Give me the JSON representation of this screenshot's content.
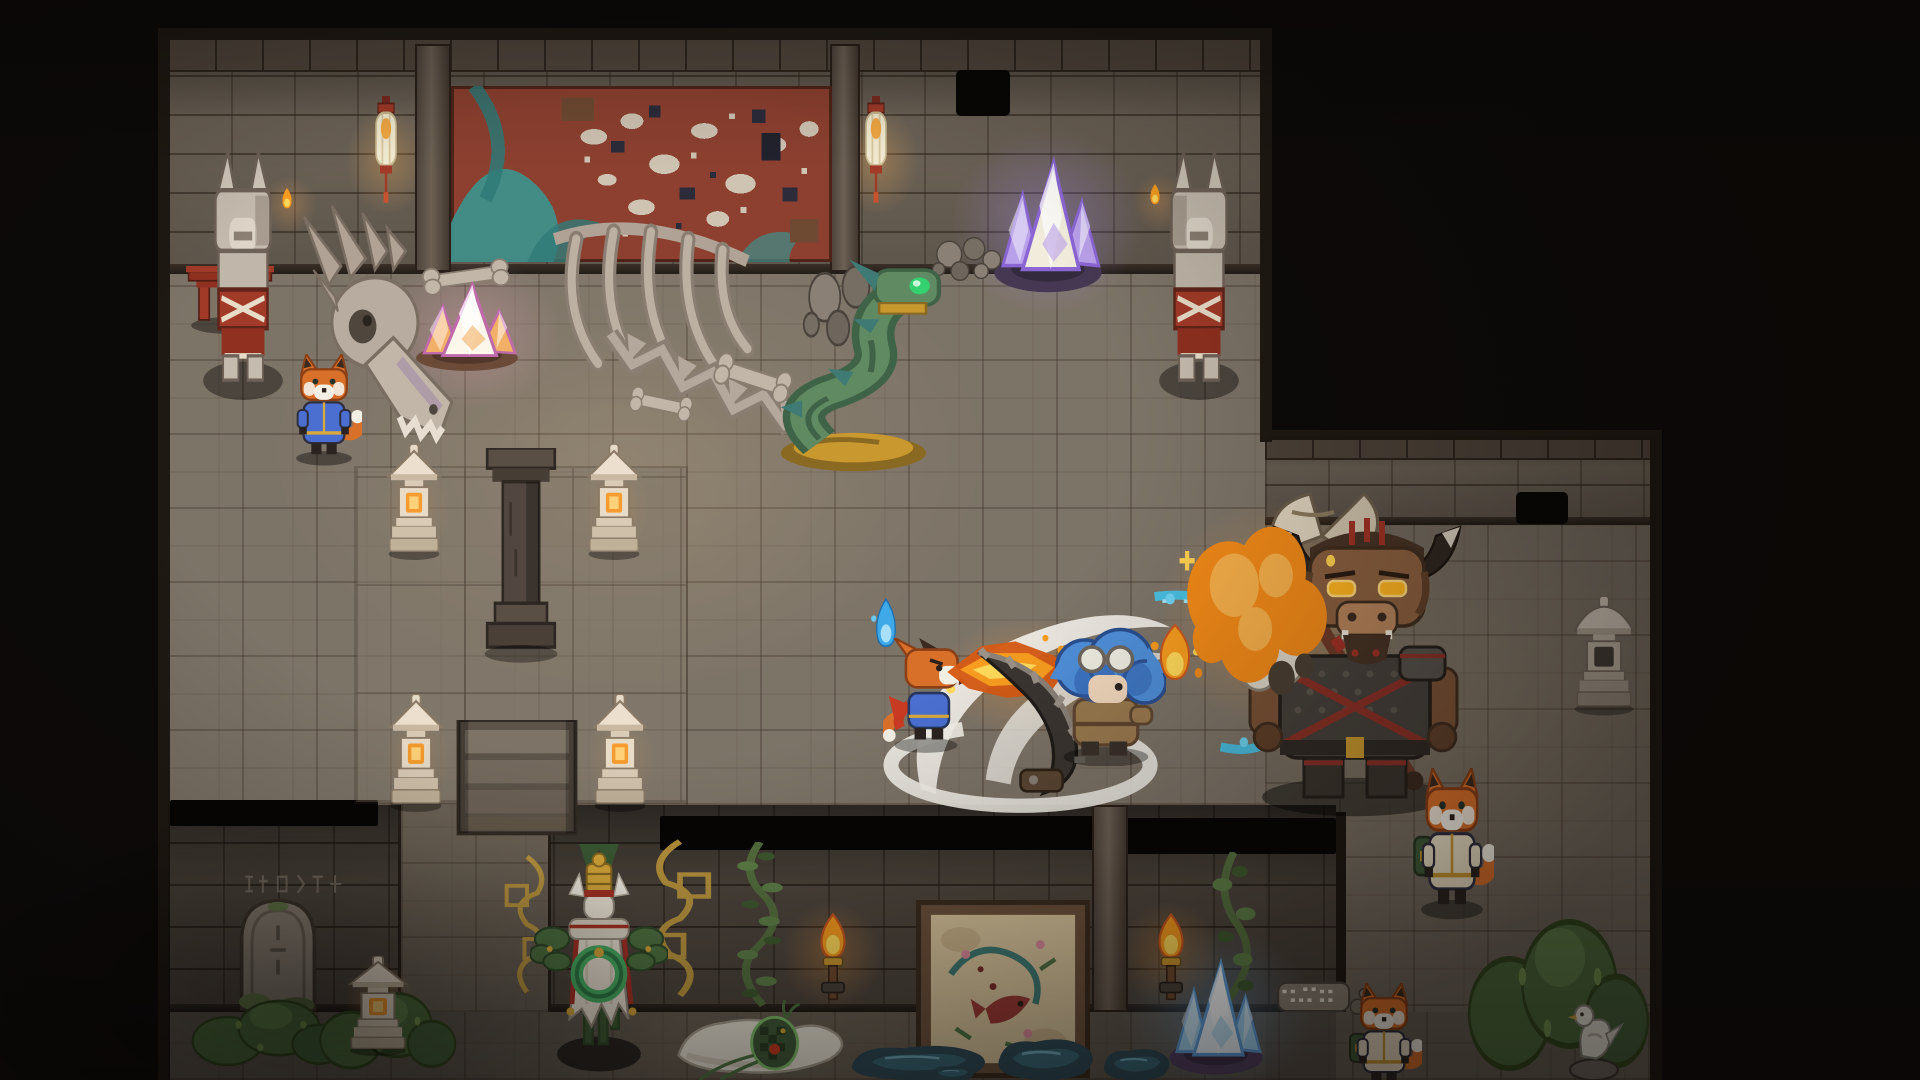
{
  "scene": {
    "palette": {
      "floor": "#7d7468",
      "floor_dark": "#6e665b",
      "wall": "#6e6458",
      "wall_dark": "#5b5248",
      "outline": "#241c15",
      "stone": "#c5bbae",
      "stone_dark": "#8a7d6f",
      "bone": "#b8aca0",
      "red": "#a23a28",
      "red_deep": "#6e241a",
      "gold": "#c9982f",
      "jade": "#49b065",
      "leaf": "#4f7342",
      "moss": "#4d6b3d",
      "fire": "#f79c1f",
      "fire_core": "#ffd95a",
      "fire_deep": "#d45a14",
      "fox": "#d9702a",
      "fox_dark": "#8a3f16",
      "fox_muzzle": "#f4efe4",
      "robe_blue": "#4a6fd0",
      "hero_hair": "#4f8fd9",
      "hero_hair_dark": "#2f5fae",
      "hero_coat": "#9a7a4f",
      "mino_fur": "#8a5f3f",
      "mino_mane": "#463224",
      "mino_armor": "#45403a",
      "eye_glow": "#ffb41f",
      "crystal_pink": "#f2b066",
      "crystal_purple": "#b9a0ea",
      "crystal_blue": "#9fd4f2",
      "mural_red": "#8d4030",
      "mural_teal": "#3f8f8a",
      "mural_cream": "#cfc3b2",
      "mural_navy": "#2b2b3a",
      "water": "#45c8f0",
      "puddle": "#2e4a57",
      "puddle_light": "#3a6a7a",
      "slash": "#f2efe8",
      "parchment": "#d8c49c",
      "frame_brown": "#6b513c"
    },
    "rooms": [
      {
        "cls": "floor",
        "name": "top-room-floor",
        "x": 168,
        "y": 272,
        "w": 1097,
        "h": 533
      },
      {
        "cls": "floor floor-right",
        "name": "right-room-floor",
        "x": 1265,
        "y": 525,
        "w": 391,
        "h": 555
      },
      {
        "cls": "floor floor-bottom",
        "name": "bottom-room-floor",
        "x": 168,
        "y": 1012,
        "w": 1488,
        "h": 68
      },
      {
        "cls": "wall-face",
        "name": "top-room-wall",
        "x": 168,
        "y": 38,
        "w": 1097,
        "h": 234
      },
      {
        "cls": "cap",
        "name": "top-wall-cap",
        "x": 168,
        "y": 38,
        "w": 1097,
        "h": 32
      },
      {
        "cls": "wall-lip",
        "name": "top-wall-lip",
        "x": 168,
        "y": 264,
        "w": 1097,
        "h": 10
      },
      {
        "cls": "wall-face",
        "name": "right-room-wall",
        "x": 1265,
        "y": 436,
        "w": 391,
        "h": 89
      },
      {
        "cls": "cap",
        "name": "right-wall-cap",
        "x": 1265,
        "y": 436,
        "w": 391,
        "h": 22
      },
      {
        "cls": "wall-lip",
        "name": "right-wall-lip",
        "x": 1265,
        "y": 517,
        "w": 391,
        "h": 8
      },
      {
        "cls": "wall-band",
        "name": "bottom-room-wall",
        "x": 168,
        "y": 805,
        "w": 1168,
        "h": 207
      },
      {
        "cls": "wall-lip",
        "name": "bottom-wall-lip",
        "x": 168,
        "y": 1004,
        "w": 1168,
        "h": 8
      },
      {
        "cls": "floor floor-passage",
        "name": "passage-floor",
        "x": 398,
        "y": 805,
        "w": 147,
        "h": 207
      },
      {
        "cls": "edge",
        "name": "map-edge-left",
        "x": 158,
        "y": 30,
        "w": 12,
        "h": 1050
      },
      {
        "cls": "edge",
        "name": "map-edge-top",
        "x": 158,
        "y": 28,
        "w": 1114,
        "h": 12
      },
      {
        "cls": "edge",
        "name": "map-edge-topright-v",
        "x": 1260,
        "y": 28,
        "w": 12,
        "h": 414
      },
      {
        "cls": "edge",
        "name": "map-edge-rightroom-top",
        "x": 1260,
        "y": 430,
        "w": 402,
        "h": 10
      },
      {
        "cls": "edge",
        "name": "map-edge-right",
        "x": 1650,
        "y": 430,
        "w": 12,
        "h": 650
      },
      {
        "cls": "edge",
        "name": "bottom-wall-right-edge",
        "x": 1336,
        "y": 812,
        "w": 10,
        "h": 200
      },
      {
        "cls": "tint",
        "name": "bottom-room-shading",
        "x": 168,
        "y": 805,
        "w": 1168,
        "h": 275
      },
      {
        "cls": "tint-light",
        "name": "right-room-shading",
        "x": 1265,
        "y": 436,
        "w": 391,
        "h": 644
      }
    ],
    "entities": [
      {
        "t": "glow",
        "n": "ambient-warm-light",
        "x": 240,
        "y": 250,
        "w": 760,
        "h": 520,
        "color": "rgba(240,200,140,0.08)"
      },
      {
        "t": "glow",
        "n": "pink-crystal-glow",
        "x": 345,
        "y": 225,
        "w": 250,
        "h": 215,
        "color": "rgba(255,170,200,0.30)"
      },
      {
        "t": "glow",
        "n": "purple-crystal-glow",
        "x": 915,
        "y": 95,
        "w": 265,
        "h": 255,
        "color": "rgba(170,140,255,0.33)"
      },
      {
        "t": "glow",
        "n": "lantern-glow",
        "x": 330,
        "y": 85,
        "w": 115,
        "h": 150,
        "color": "rgba(255,180,80,0.30)"
      },
      {
        "t": "glow",
        "n": "lantern-glow",
        "x": 820,
        "y": 85,
        "w": 115,
        "h": 150,
        "color": "rgba(255,180,80,0.30)"
      },
      {
        "t": "glow",
        "n": "stone-lantern-glow",
        "x": 368,
        "y": 445,
        "w": 95,
        "h": 130,
        "color": "rgba(255,170,70,0.28)"
      },
      {
        "t": "glow",
        "n": "stone-lantern-glow",
        "x": 568,
        "y": 445,
        "w": 95,
        "h": 130,
        "color": "rgba(255,170,70,0.28)"
      },
      {
        "t": "glow",
        "n": "stone-lantern-glow",
        "x": 370,
        "y": 692,
        "w": 95,
        "h": 132,
        "color": "rgba(255,170,70,0.28)"
      },
      {
        "t": "glow",
        "n": "stone-lantern-glow",
        "x": 574,
        "y": 692,
        "w": 95,
        "h": 132,
        "color": "rgba(255,170,70,0.28)"
      },
      {
        "t": "glow",
        "n": "stone-lantern-glow",
        "x": 330,
        "y": 940,
        "w": 100,
        "h": 130,
        "color": "rgba(255,170,70,0.28)"
      },
      {
        "t": "glow",
        "n": "fire-breath-glow",
        "x": 905,
        "y": 595,
        "w": 250,
        "h": 165,
        "color": "rgba(255,150,40,0.30)"
      },
      {
        "t": "glow",
        "n": "explosion-glow",
        "x": 1110,
        "y": 455,
        "w": 340,
        "h": 320,
        "color": "rgba(255,160,60,0.33)"
      },
      {
        "t": "glow",
        "n": "blue-crystal-glow",
        "x": 1085,
        "y": 895,
        "w": 265,
        "h": 235,
        "color": "rgba(110,190,255,0.30)"
      },
      {
        "t": "glow",
        "n": "torch-glow",
        "x": 762,
        "y": 880,
        "w": 140,
        "h": 150,
        "color": "rgba(255,160,60,0.30)"
      },
      {
        "t": "glow",
        "n": "torch-glow",
        "x": 1100,
        "y": 880,
        "w": 140,
        "h": 150,
        "color": "rgba(255,160,60,0.30)"
      },
      {
        "t": "glow",
        "n": "statue-ember-glow",
        "x": 252,
        "y": 165,
        "w": 75,
        "h": 80,
        "color": "rgba(255,170,80,0.25)"
      },
      {
        "t": "glow",
        "n": "statue-ember-glow",
        "x": 1122,
        "y": 162,
        "w": 75,
        "h": 80,
        "color": "rgba(255,170,80,0.25)"
      },
      {
        "t": "pillar",
        "n": "wall-pillar",
        "x": 415,
        "y": 44,
        "w": 36,
        "h": 228
      },
      {
        "t": "pillar",
        "n": "wall-pillar",
        "x": 830,
        "y": 44,
        "w": 30,
        "h": 228
      },
      {
        "t": "mural-top",
        "n": "wall-mural-tapestry",
        "x": 451,
        "y": 86,
        "w": 381,
        "h": 176
      },
      {
        "t": "hole",
        "n": "broken-wall-hole",
        "x": 956,
        "y": 70,
        "w": 54,
        "h": 46
      },
      {
        "t": "hole",
        "n": "broken-wall-hole",
        "x": 1516,
        "y": 492,
        "w": 52,
        "h": 32
      },
      {
        "t": "pit",
        "n": "wall-opening-slot",
        "x": 170,
        "y": 800,
        "w": 208,
        "h": 26
      },
      {
        "t": "pit",
        "n": "wall-opening-slot",
        "x": 660,
        "y": 816,
        "w": 434,
        "h": 34
      },
      {
        "t": "pit",
        "n": "wall-opening-slot",
        "x": 1126,
        "y": 818,
        "w": 210,
        "h": 36
      },
      {
        "t": "pillar",
        "n": "wall-pillar",
        "x": 1092,
        "y": 805,
        "w": 36,
        "h": 207
      },
      {
        "t": "carved-marks",
        "n": "wall-carvings",
        "x": 238,
        "y": 868,
        "w": 112,
        "h": 32
      },
      {
        "t": "vine",
        "n": "wall-vine",
        "x": 726,
        "y": 842,
        "w": 68,
        "h": 168
      },
      {
        "t": "vine",
        "n": "wall-vine",
        "x": 1202,
        "y": 852,
        "w": 64,
        "h": 228
      },
      {
        "t": "halo-arc",
        "n": "gold-filigree",
        "x": 494,
        "y": 852,
        "w": 66,
        "h": 145
      },
      {
        "t": "halo-arc",
        "n": "gold-filigree",
        "x": 634,
        "y": 836,
        "w": 92,
        "h": 165,
        "flip": true
      },
      {
        "t": "mural-bottom",
        "n": "wall-fresco",
        "x": 916,
        "y": 900,
        "w": 174,
        "h": 178
      },
      {
        "t": "torch",
        "n": "wall-torch",
        "x": 808,
        "y": 910,
        "w": 50,
        "h": 106
      },
      {
        "t": "torch",
        "n": "wall-torch",
        "x": 1146,
        "y": 910,
        "w": 50,
        "h": 106
      },
      {
        "t": "patch",
        "n": "altar-floor-tiles",
        "x": 356,
        "y": 468,
        "w": 330,
        "h": 334
      },
      {
        "t": "red-shrine",
        "n": "red-shrine-remnant",
        "x": 186,
        "y": 266,
        "w": 88,
        "h": 68
      },
      {
        "t": "paper-lantern",
        "n": "hanging-lantern",
        "x": 368,
        "y": 96,
        "w": 36,
        "h": 124
      },
      {
        "t": "paper-lantern",
        "n": "hanging-lantern",
        "x": 858,
        "y": 96,
        "w": 36,
        "h": 124
      },
      {
        "t": "fox-statue",
        "n": "fox-guardian-statue",
        "x": 194,
        "y": 146,
        "w": 98,
        "h": 254
      },
      {
        "t": "fox-statue",
        "n": "fox-guardian-statue",
        "x": 1150,
        "y": 146,
        "w": 98,
        "h": 254,
        "flip": true
      },
      {
        "t": "ember",
        "n": "statue-flame",
        "x": 278,
        "y": 186,
        "w": 18,
        "h": 26
      },
      {
        "t": "ember",
        "n": "statue-flame",
        "x": 1146,
        "y": 182,
        "w": 18,
        "h": 26
      },
      {
        "t": "crystal",
        "n": "purple-crystal-cluster",
        "x": 986,
        "y": 152,
        "w": 124,
        "h": 142,
        "css": {
          "--c1": "#f2ecdc",
          "--c2": "#b9a0ea",
          "--c3": "#8a66d4",
          "--mound": "#463853"
        }
      },
      {
        "t": "dragon-skull",
        "n": "dragon-skull-bones",
        "x": 298,
        "y": 202,
        "w": 160,
        "h": 264
      },
      {
        "t": "ribcage",
        "n": "skeleton-ribcage",
        "x": 542,
        "y": 210,
        "w": 218,
        "h": 168
      },
      {
        "t": "spine-tail",
        "n": "skeleton-spine",
        "x": 598,
        "y": 326,
        "w": 235,
        "h": 100,
        "rot": 10
      },
      {
        "t": "bone",
        "n": "scattered-bone",
        "x": 420,
        "y": 262,
        "w": 92,
        "h": 30,
        "rot": -8
      },
      {
        "t": "bone",
        "n": "scattered-bone",
        "x": 628,
        "y": 390,
        "w": 66,
        "h": 28,
        "rot": 12
      },
      {
        "t": "bone",
        "n": "scattered-bone",
        "x": 712,
        "y": 360,
        "w": 82,
        "h": 36,
        "rot": 18
      },
      {
        "t": "pebbles",
        "n": "rock-pile",
        "x": 798,
        "y": 256,
        "w": 98,
        "h": 96
      },
      {
        "t": "pebbles",
        "n": "rock-pile",
        "x": 928,
        "y": 232,
        "w": 78,
        "h": 52
      },
      {
        "t": "crystal",
        "n": "pink-crystal-cluster",
        "x": 408,
        "y": 278,
        "w": 118,
        "h": 94,
        "css": {
          "--c1": "#fdf6ea",
          "--c2": "#f2b066",
          "--c3": "#c06aac",
          "--mound": "#6b4a38"
        }
      },
      {
        "t": "serpent",
        "n": "jade-serpent-statue",
        "x": 768,
        "y": 256,
        "w": 188,
        "h": 218
      },
      {
        "t": "pedestal",
        "n": "stone-pedestal",
        "x": 482,
        "y": 448,
        "w": 78,
        "h": 216
      },
      {
        "t": "steps",
        "n": "altar-steps",
        "x": 452,
        "y": 720,
        "w": 130,
        "h": 120
      },
      {
        "t": "stone-lantern",
        "n": "stone-lantern-lit",
        "x": 384,
        "y": 444,
        "w": 60,
        "h": 116
      },
      {
        "t": "stone-lantern",
        "n": "stone-lantern-lit",
        "x": 584,
        "y": 444,
        "w": 60,
        "h": 116
      },
      {
        "t": "stone-lantern",
        "n": "stone-lantern-lit",
        "x": 386,
        "y": 694,
        "w": 60,
        "h": 118
      },
      {
        "t": "stone-lantern",
        "n": "stone-lantern-lit",
        "x": 590,
        "y": 694,
        "w": 60,
        "h": 118
      },
      {
        "t": "fox-npc",
        "n": "fox-npc-blue-robe",
        "x": 286,
        "y": 354,
        "w": 76,
        "h": 112,
        "variant": "plain",
        "inter": true,
        "css": {
          "--robe": "#4a6fd0",
          "--trim": "#d9a93a"
        }
      },
      {
        "t": "blue-flame",
        "n": "blue-flame-wisp",
        "x": 870,
        "y": 596,
        "w": 32,
        "h": 58
      },
      {
        "t": "slash-arcs",
        "n": "sword-slash-effect",
        "x": 876,
        "y": 594,
        "w": 324,
        "h": 226
      },
      {
        "t": "fox-fighter",
        "n": "fox-fighter-player",
        "x": 883,
        "y": 638,
        "w": 86,
        "h": 116,
        "inter": true
      },
      {
        "t": "fire-breath",
        "n": "fire-breath-attack",
        "x": 943,
        "y": 632,
        "w": 128,
        "h": 80
      },
      {
        "t": "chainsaw",
        "n": "chainsaw-blade-weapon",
        "x": 946,
        "y": 646,
        "w": 162,
        "h": 154
      },
      {
        "t": "hero",
        "n": "blue-haired-hero",
        "x": 1046,
        "y": 626,
        "w": 120,
        "h": 140,
        "inter": true
      },
      {
        "t": "water-trail",
        "n": "water-magic-trail",
        "x": 1143,
        "y": 583,
        "w": 194,
        "h": 182
      },
      {
        "t": "fire-puff",
        "n": "flame-burst",
        "x": 1146,
        "y": 622,
        "w": 58,
        "h": 66
      },
      {
        "t": "minotaur",
        "n": "minotaur-boss",
        "x": 1190,
        "y": 488,
        "w": 288,
        "h": 330,
        "inter": true
      },
      {
        "t": "explosion",
        "n": "explosion-cloud",
        "x": 1172,
        "y": 512,
        "w": 170,
        "h": 195
      },
      {
        "t": "stone-lantern-tall",
        "n": "stone-lantern-unlit",
        "x": 1570,
        "y": 596,
        "w": 68,
        "h": 120
      },
      {
        "t": "fox-npc",
        "n": "fox-npc-with-satchel",
        "x": 1410,
        "y": 768,
        "w": 84,
        "h": 152,
        "variant": "bag",
        "inter": true,
        "css": {
          "--robe": "#e8dcc2",
          "--trim": "#c9982f"
        }
      },
      {
        "t": "gravestone",
        "n": "mossy-gravestone",
        "x": 226,
        "y": 886,
        "w": 104,
        "h": 128
      },
      {
        "t": "moss",
        "n": "moss-patch",
        "x": 190,
        "y": 986,
        "w": 162,
        "h": 84
      },
      {
        "t": "moss",
        "n": "moss-patch",
        "x": 318,
        "y": 976,
        "w": 142,
        "h": 98
      },
      {
        "t": "stone-lantern",
        "n": "stone-lantern-lit",
        "x": 345,
        "y": 956,
        "w": 66,
        "h": 100
      },
      {
        "t": "goddess",
        "n": "goddess-statue",
        "x": 530,
        "y": 844,
        "w": 138,
        "h": 240
      },
      {
        "t": "slime",
        "n": "pale-serpent-creature",
        "x": 666,
        "y": 994,
        "w": 188,
        "h": 86,
        "inter": true
      },
      {
        "t": "puddle",
        "n": "water-puddle",
        "x": 840,
        "y": 1038,
        "w": 158,
        "h": 44
      },
      {
        "t": "puddle",
        "n": "water-puddle",
        "x": 990,
        "y": 1030,
        "w": 112,
        "h": 52
      },
      {
        "t": "puddle",
        "n": "water-puddle",
        "x": 1098,
        "y": 1042,
        "w": 78,
        "h": 40
      },
      {
        "t": "puddle",
        "n": "water-puddle",
        "x": 928,
        "y": 1062,
        "w": 50,
        "h": 20
      },
      {
        "t": "crystal",
        "n": "blue-crystal-cluster",
        "x": 1162,
        "y": 954,
        "w": 108,
        "h": 122,
        "css": {
          "--c1": "#eef7fd",
          "--c2": "#9fd4f2",
          "--c3": "#5f9fdc",
          "--mound": "#514063"
        }
      },
      {
        "t": "rock-slab",
        "n": "engraved-stone-slab",
        "x": 1274,
        "y": 974,
        "w": 96,
        "h": 48
      },
      {
        "t": "moss",
        "n": "moss-patch-large",
        "x": 1466,
        "y": 888,
        "w": 188,
        "h": 192
      },
      {
        "t": "fox-npc",
        "n": "fox-npc-bottom",
        "x": 1346,
        "y": 983,
        "w": 76,
        "h": 112,
        "variant": "bag",
        "inter": true,
        "css": {
          "--robe": "#e8dcc2",
          "--trim": "#c9982f"
        }
      },
      {
        "t": "bird-statue",
        "n": "white-bird-statue",
        "x": 1564,
        "y": 991,
        "w": 60,
        "h": 90
      }
    ]
  }
}
